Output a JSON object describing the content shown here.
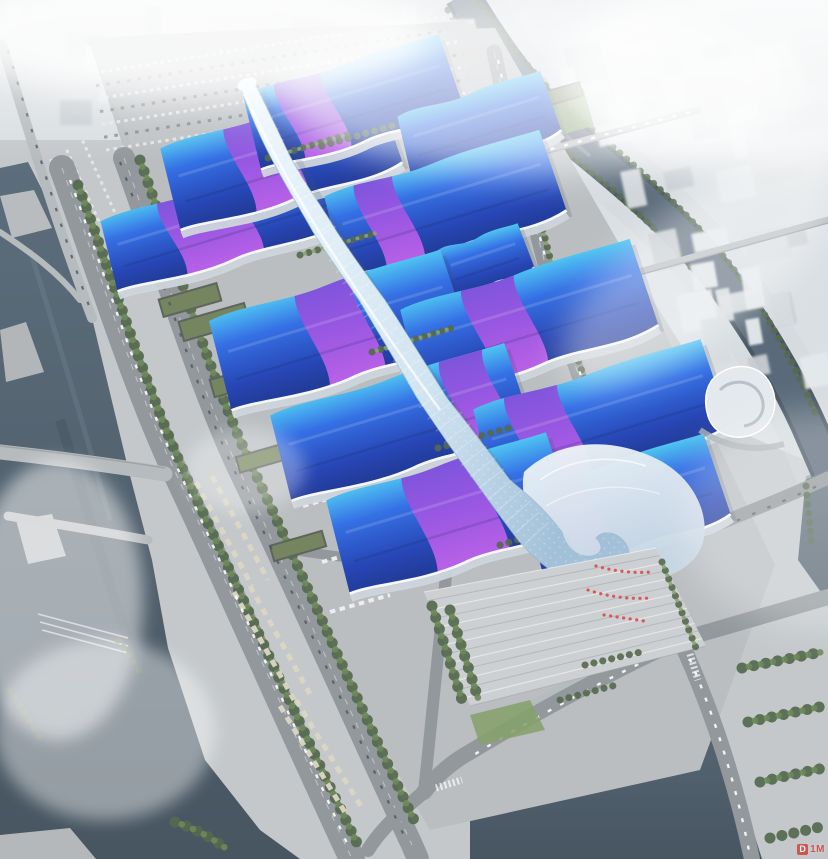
{
  "watermark": {
    "badge": "D",
    "text": "1M"
  },
  "palette": {
    "hallCyan": "#46c2f2",
    "hallBlue": "#2b6ae4",
    "hallNavy": "#1c3cb0",
    "hallDeep": "#16308f",
    "bandMagenta": "#c45ded",
    "bandPurple": "#7a43d8",
    "spineLight": "#eef7fd",
    "spineMid": "#cfe3f1",
    "spineShade": "#9dbdd6",
    "shellLight": "#eef4f9",
    "shellMid": "#c3d4e2",
    "concrete": "#b7bbbe",
    "plaza": "#cbced0",
    "road": "#8d9397",
    "roadLight": "#b3b8bb",
    "laneWhite": "#f2f4f5",
    "treeDark": "#4c6245",
    "treeMid": "#66834f",
    "treeLight": "#85a164",
    "lawn": "#7f9c62",
    "waterDark": "#3e4d59",
    "water": "#546675",
    "waterLight": "#7b8c98",
    "cityA": "#e3e8eb",
    "cityB": "#d4dadd",
    "cityC": "#c5ccd1",
    "wall": "#ccd4db",
    "trim": "#f4f8fb",
    "busBeige": "#d9d5c0",
    "crowdRed": "#d8454a",
    "watermarkRed": "#cf3a33"
  }
}
